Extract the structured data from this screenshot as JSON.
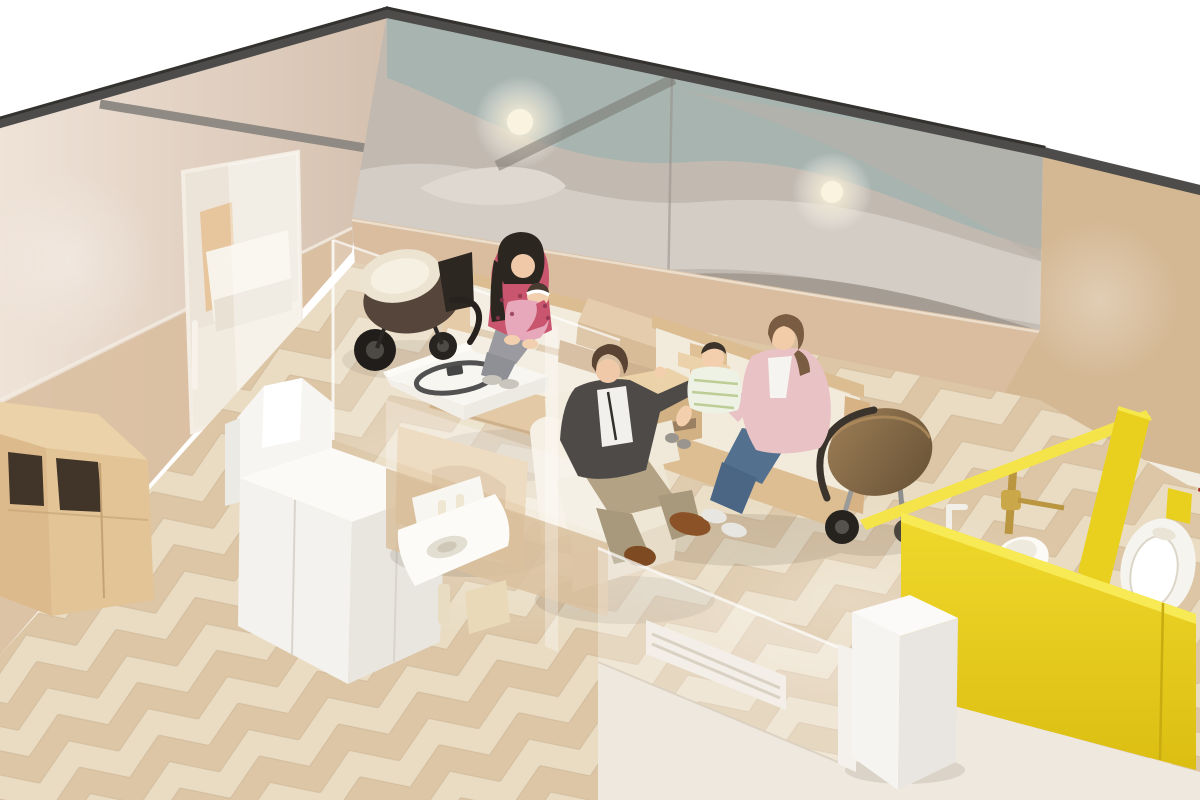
{
  "scene": {
    "type": "3d-architectural-rendering",
    "subject": "baby care / nursing room interior, isometric cutaway view",
    "visible_text": "none",
    "people": [
      {
        "label": "mother-with-baby",
        "clothing": "pink floral top, gray leggings",
        "location": "left wooden bench sofa"
      },
      {
        "label": "baby",
        "clothing": "pink outfit, white headband",
        "location": "on mother's lap"
      },
      {
        "label": "father",
        "clothing": "charcoal jacket, white t-shirt, khaki pants, brown shoes",
        "location": "cream armchair"
      },
      {
        "label": "mother-with-toddler",
        "clothing": "light pink cardigan, blue jeans, white flats",
        "location": "right wooden bench sofa"
      },
      {
        "label": "toddler",
        "clothing": "white and green striped dress with bib",
        "location": "on mother's lap"
      }
    ],
    "objects": [
      "wavy wallpaper feature wall",
      "ceiling light glows",
      "beige walls with tan wainscot",
      "sliding glass door to private nursing room",
      "daybed in private room",
      "dark stroller",
      "brown bassinet stroller",
      "oak storage cabinet",
      "white service cabinet",
      "diaper changing table with safety strap",
      "wall-hung hand sink with dispenser",
      "translucent glass partitions",
      "left bench sofa",
      "right bench sofa",
      "cream armchair",
      "wooden side table",
      "back bench",
      "front glass wall with air vent",
      "white waste bin",
      "mosaic tiled toilet wall",
      "child toilet with brass flushometer",
      "grab bar",
      "wall-hung urinal with sensor",
      "yellow toilet partitions",
      "herringbone wood floor",
      "pale corridor floor outside"
    ],
    "palette": {
      "outside_white": "#ffffff",
      "wall_cap_gray": "#4e4c4a",
      "partition_cap_gray": "#8f8a83",
      "wall_beige": "#dcc8b6",
      "wall_wainscot_tan": "#d9bd9e",
      "wall_tan_right": "#d3b globalization",
      "wall_tan": "#d4b894",
      "wallpaper_gray_base": "#c2bab1",
      "wallpaper_teal": "#a8b4b0",
      "wallpaper_light": "#d5cec6",
      "wallpaper_dark": "#a59d94",
      "floor_wood_light": "#e9dcc3",
      "floor_wood_dark": "#dcc6a6",
      "outside_floor": "#efe8de",
      "wood_light_oak": "#e2c49c",
      "wood_mid_oak": "#d5b389",
      "cushion_cream": "#f2ebdc",
      "accent_yellow": "#e9d01f",
      "accent_yellow_light": "#f4e44a",
      "mosaic_red": "#a8322a",
      "mosaic_tan": "#c59a58",
      "mosaic_olive": "#8d7b46",
      "mosaic_cream": "#d9c69c",
      "glass_white": "#ffffff",
      "stroller_brown": "#7c6245",
      "skin": "#f0c9a8"
    }
  }
}
